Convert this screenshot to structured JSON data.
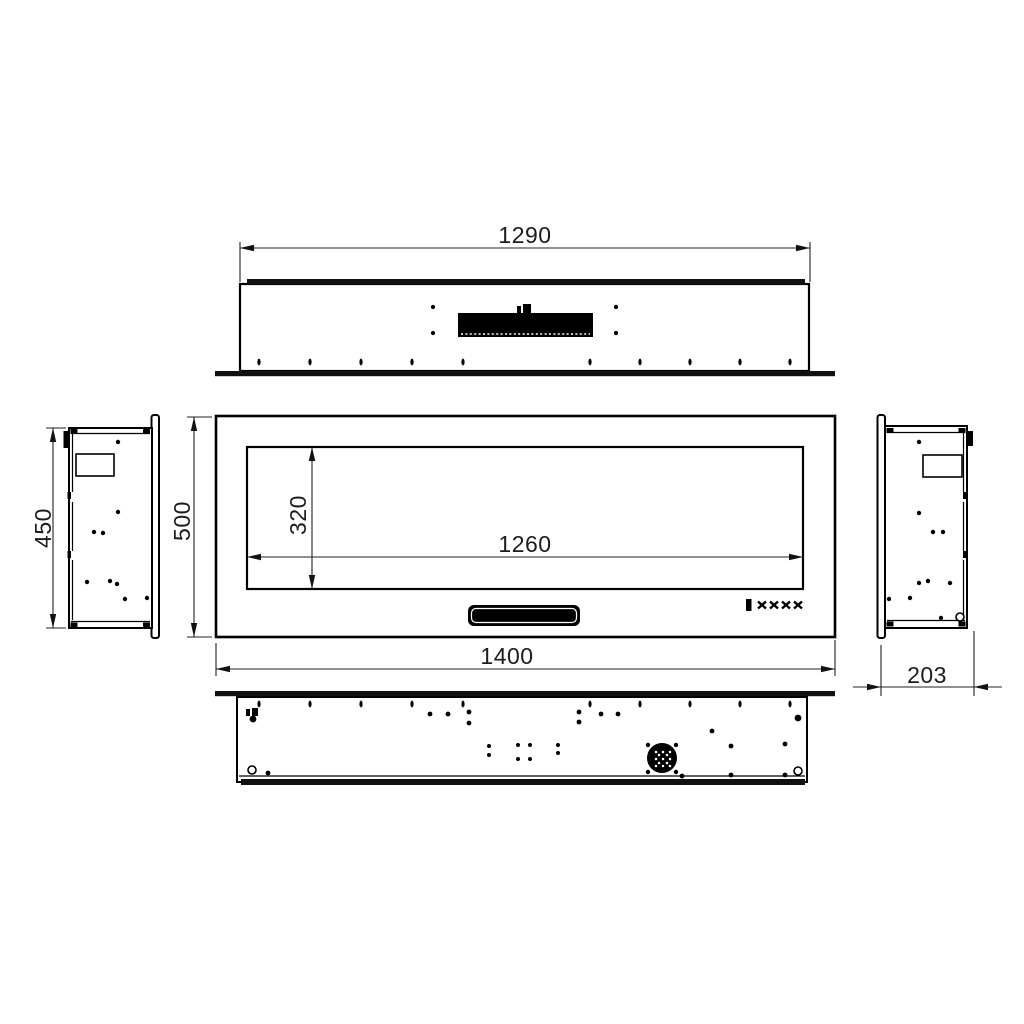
{
  "colors": {
    "paper": "#ffffff",
    "ink": "#000000",
    "dim_text": "#1c1c1c"
  },
  "dimensions": {
    "top_width": "1290",
    "viewing_width": "1260",
    "viewing_height": "320",
    "front_width": "1400",
    "front_height": "500",
    "side_height": "450",
    "side_depth": "203"
  },
  "holes": {
    "top_view_dots": [
      [
        433,
        307
      ],
      [
        433,
        333
      ],
      [
        616,
        307
      ],
      [
        616,
        333
      ]
    ],
    "left_view_dots": [
      [
        118,
        442
      ],
      [
        118,
        512
      ],
      [
        94,
        532
      ],
      [
        103,
        533
      ],
      [
        87,
        582
      ],
      [
        110,
        581
      ],
      [
        117,
        584
      ],
      [
        125,
        599
      ],
      [
        147,
        598
      ]
    ],
    "right_view_dots": [
      [
        919,
        442
      ],
      [
        919,
        513
      ],
      [
        933,
        532
      ],
      [
        943,
        532
      ],
      [
        919,
        583
      ],
      [
        928,
        581
      ],
      [
        950,
        583
      ],
      [
        889,
        599
      ],
      [
        910,
        598
      ],
      [
        941,
        618
      ]
    ],
    "bottom_view_dots": [
      [
        430,
        714
      ],
      [
        448,
        714
      ],
      [
        469,
        712
      ],
      [
        469,
        723
      ],
      [
        579,
        712
      ],
      [
        579,
        722
      ],
      [
        601,
        714
      ],
      [
        618,
        714
      ],
      [
        712,
        731
      ],
      [
        731,
        746
      ],
      [
        731,
        775
      ],
      [
        785,
        744
      ],
      [
        785,
        775
      ],
      [
        682,
        776
      ],
      [
        268,
        773
      ]
    ],
    "bottom_view_big_dots": [
      [
        253,
        719
      ],
      [
        798,
        718
      ]
    ],
    "bottom_cluster_dots": [
      [
        489,
        746
      ],
      [
        489,
        755
      ],
      [
        518,
        745
      ],
      [
        530,
        745
      ],
      [
        518,
        759
      ],
      [
        530,
        759
      ],
      [
        558,
        745
      ],
      [
        558,
        753
      ]
    ],
    "rings_bottom": [
      [
        252,
        770
      ],
      [
        798,
        771
      ]
    ],
    "rings_right": [
      [
        960,
        617
      ]
    ],
    "slot_xs": [
      259,
      310,
      361,
      412,
      463,
      590,
      640,
      690,
      740,
      790
    ],
    "fan": {
      "cx": 662,
      "cy": 758,
      "r": 15,
      "corner_dots": [
        [
          648,
          745
        ],
        [
          676,
          745
        ],
        [
          648,
          772
        ],
        [
          676,
          772
        ]
      ],
      "speckles": [
        [
          656,
          752
        ],
        [
          663,
          752
        ],
        [
          670,
          752
        ],
        [
          656,
          759
        ],
        [
          663,
          759
        ],
        [
          670,
          759
        ],
        [
          656,
          766
        ],
        [
          663,
          766
        ],
        [
          670,
          766
        ],
        [
          659,
          755
        ],
        [
          667,
          755
        ],
        [
          659,
          763
        ],
        [
          667,
          763
        ]
      ]
    }
  }
}
